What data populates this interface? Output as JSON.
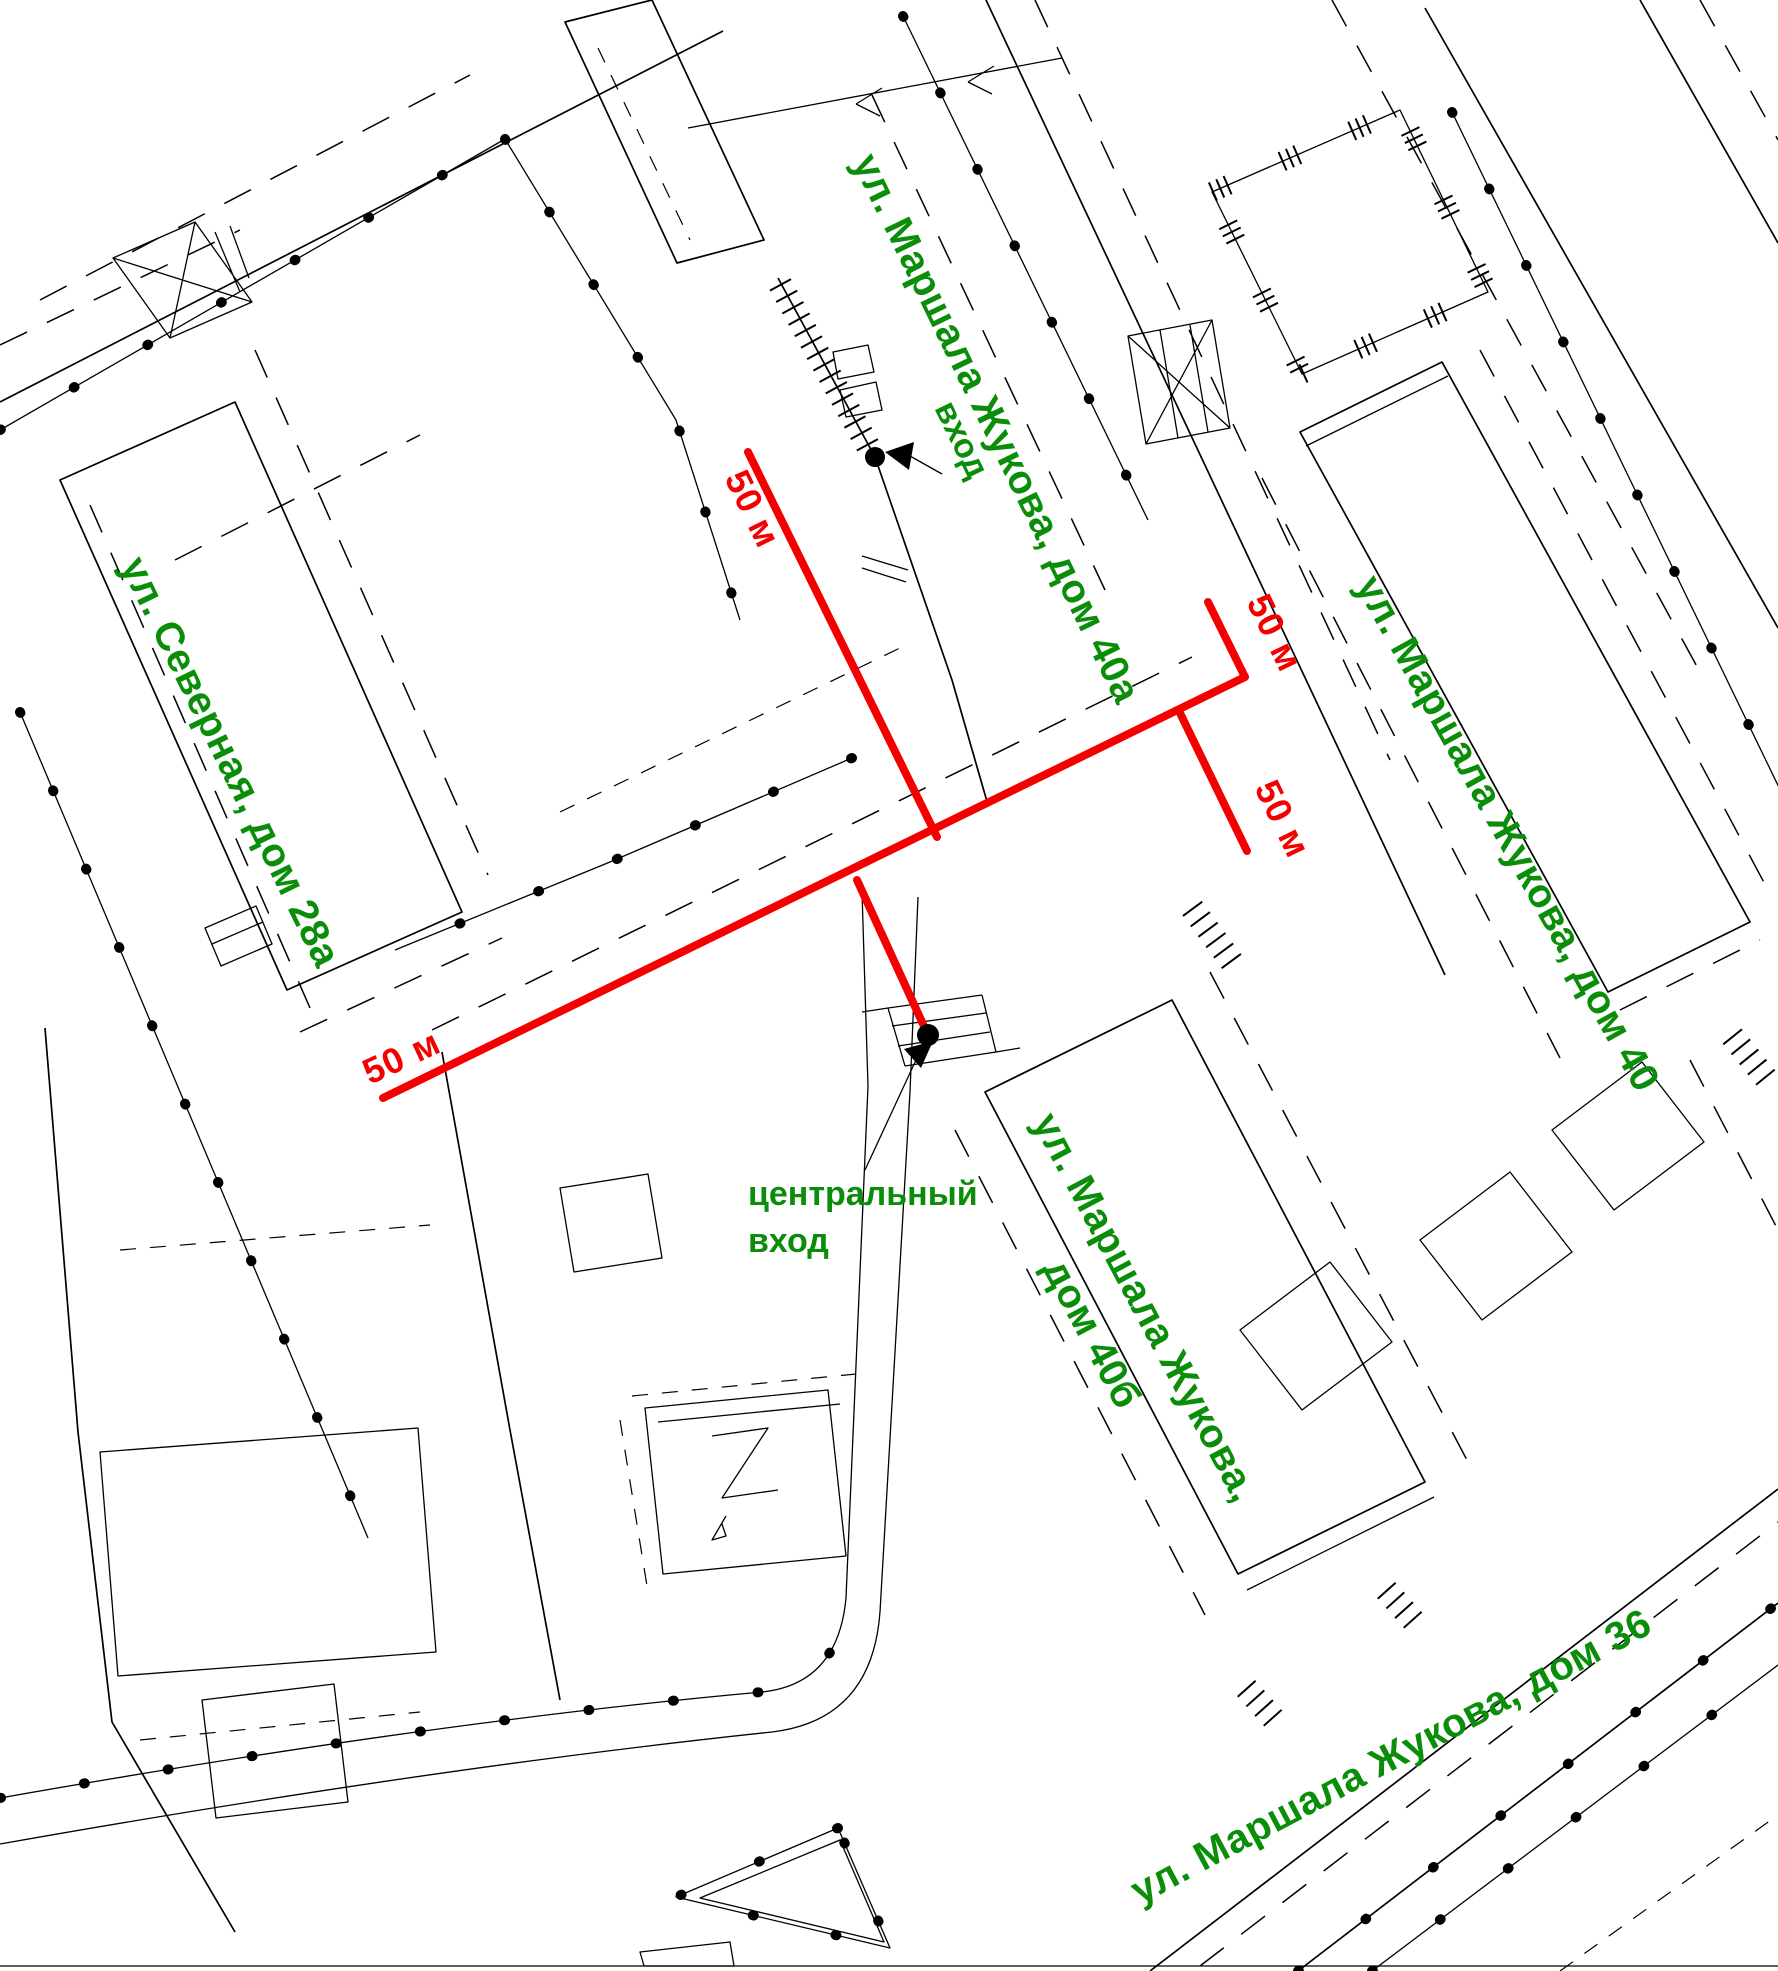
{
  "map": {
    "streets": [
      {
        "id": "zhukova40a",
        "label": "ул. Маршала Жукова, дом 40а"
      },
      {
        "id": "zhukova40",
        "label": "ул. Маршала Жукова, дом 40"
      },
      {
        "id": "severnaya28a",
        "label": "ул. Северная, дом 28а"
      },
      {
        "id": "zhukova40b_1",
        "label": "ул. Маршала Жукова,"
      },
      {
        "id": "zhukova40b_2",
        "label": "дом 40б"
      },
      {
        "id": "zhukova36",
        "label": "ул. Маршала Жукова, дом 36"
      }
    ],
    "entrances": {
      "side_label": "вход",
      "central_label_line1": "центральный",
      "central_label_line2": "вход"
    },
    "distances": {
      "d1": "50 м",
      "d2": "50 м",
      "d3": "50 м",
      "d4": "50 м"
    },
    "colors": {
      "route_red": "#f40000",
      "label_green": "#0a8e0a",
      "linework": "#000000",
      "background": "#ffffff"
    }
  }
}
